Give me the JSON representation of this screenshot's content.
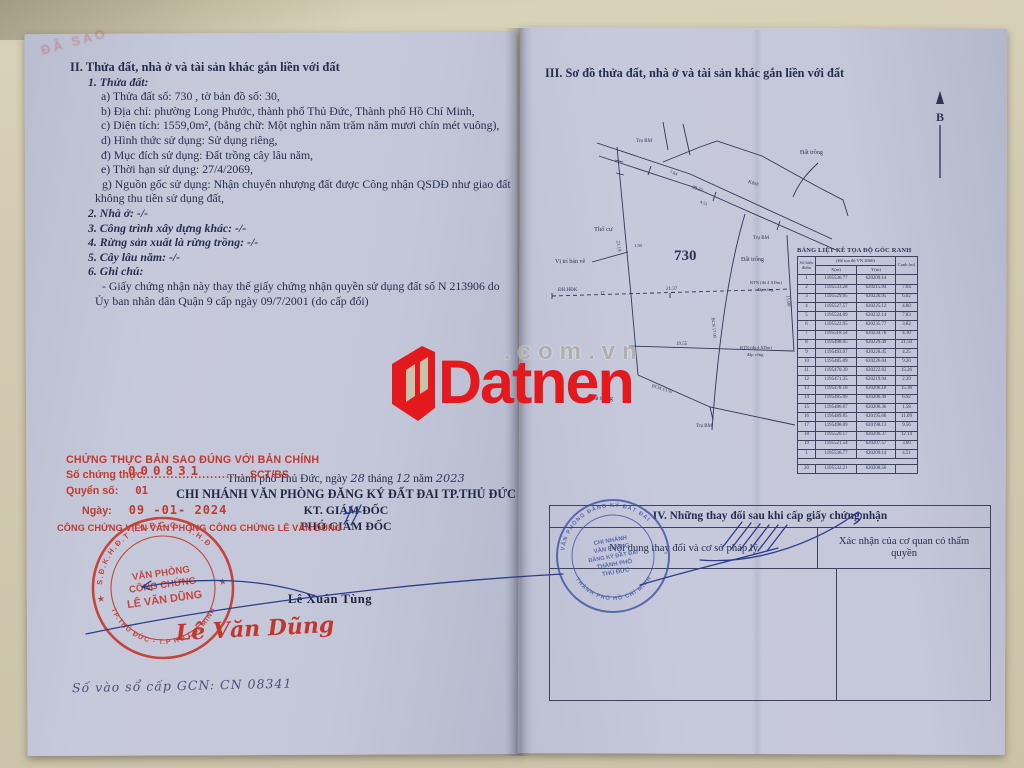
{
  "watermark": {
    "brand": "Datnen",
    "suffix": ".com.vn"
  },
  "colors": {
    "accent_red": "#e3191d",
    "stamp_red": "#c43c31",
    "stamp_blue": "#3f51a3",
    "page": "#c3c6d8",
    "ink": "#262e50"
  },
  "left_page": {
    "faint_corner_stamp": "ĐÃ SAO",
    "section2": {
      "heading": "II. Thửa đất, nhà ở và tài sản khác gắn liền với đất",
      "lines": [
        {
          "style": "h2",
          "text": "1. Thửa đất:"
        },
        {
          "style": "item",
          "text": "a) Thửa đất số: 730      , tờ bản đồ số: 30,"
        },
        {
          "style": "item",
          "text": "b) Địa chỉ: phường Long Phước, thành phố Thủ Đức, Thành phố Hồ Chí Minh,"
        },
        {
          "style": "item",
          "text": "c) Diện tích: 1559,0m², (bằng chữ: Một nghìn năm trăm năm mươi chín mét vuông),"
        },
        {
          "style": "item",
          "text": "d) Hình thức sử dụng: Sử dụng riêng,"
        },
        {
          "style": "item",
          "text": "đ) Mục đích sử dụng: Đất trồng cây lâu năm,"
        },
        {
          "style": "item",
          "text": "e) Thời hạn sử dụng: 27/4/2069,"
        },
        {
          "style": "wrap",
          "text": "g) Nguồn gốc sử dụng: Nhận chuyển nhượng đất được Công nhận QSDĐ như giao đất không thu tiền sử dụng đất,"
        },
        {
          "style": "h2",
          "text": "2. Nhà ở: -/-"
        },
        {
          "style": "h2",
          "text": "3. Công trình xây dựng khác: -/-"
        },
        {
          "style": "h2",
          "text": "4. Rừng sản xuất là rừng trồng: -/-"
        },
        {
          "style": "h2",
          "text": "5. Cây lâu năm: -/-"
        },
        {
          "style": "h2",
          "text": "6. Ghi chú:"
        },
        {
          "style": "wrap",
          "text": "- Giấy chứng nhận này thay thế giấy chứng nhận quyền sử dụng đất số N 213906 do Ủy ban nhân dân Quận 9 cấp ngày 09/7/2001 (do cấp đổi)"
        }
      ]
    },
    "certification": {
      "line1": "CHỨNG THỰC BẢN SAO ĐÚNG VỚI BẢN CHÍNH",
      "serial_label": "Số chứng thực",
      "serial_dots": "...........................",
      "serial_number": "000831",
      "serial_suffix": "SCT/BS",
      "book_label": "Quyển số:",
      "book_number": "01",
      "date_label": "Ngày:",
      "date_stamp": "09 -01- 2024",
      "notary_line": "CÔNG CHỨNG VIÊN VĂN PHÒNG CÔNG CHỨNG LÊ VĂN DŨNG"
    },
    "issuing": {
      "pd1": "Thành phố Thủ Đức, ngày",
      "day": "28",
      "pd2": "tháng",
      "month": "12",
      "pd3": "năm",
      "year": "2023",
      "office": "CHI NHÁNH VĂN PHÒNG ĐĂNG KÝ ĐẤT ĐAI TP.THỦ ĐỨC",
      "title1": "KT. GIÁM ĐỐC",
      "title2": "PHÓ GIÁM ĐỐC",
      "signer": "Lê Xuân Tùng"
    },
    "red_stamp": {
      "ring_top": "S.Đ.K.H.Đ.T · V.P.C.C · T.H.Đ",
      "ring_bottom": "TP.THỦ ĐỨC - T.P HỒ CHÍ MINH",
      "center1": "VĂN PHÒNG",
      "center2": "CÔNG CHỨNG",
      "center3": "LÊ VĂN DŨNG",
      "star": "★"
    },
    "blue_stamp": {
      "ring_top": "VĂN PHÒNG ĐĂNG KÝ ĐẤT ĐAI",
      "ring_bottom": "THÀNH PHỐ HỒ CHÍ MINH",
      "center": [
        "CHI NHÁNH",
        "VĂN PHÒNG",
        "ĐĂNG KÝ ĐẤT ĐAI",
        "THÀNH PHỐ",
        "THỦ ĐỨC"
      ]
    },
    "notary_signature": "Lê Văn Dũng",
    "registry_line": "Số vào sổ cấp GCN: CN  08341"
  },
  "right_page": {
    "heading": "III. Sơ đồ thửa đất, nhà ở và tài sản khác gắn liền với đất",
    "north_label": "B",
    "diagram": {
      "labels": [
        {
          "t": "Trụ BM",
          "x": 636,
          "y": 139,
          "s": 5
        },
        {
          "t": "Trụ BM",
          "x": 753,
          "y": 236,
          "s": 5
        },
        {
          "t": "Trụ BM",
          "x": 696,
          "y": 424,
          "s": 5
        },
        {
          "t": "Thổ cư",
          "x": 594,
          "y": 226,
          "s": 6.5
        },
        {
          "t": "Vị trí bản vẽ",
          "x": 555,
          "y": 259,
          "s": 6
        },
        {
          "t": "730",
          "x": 674,
          "y": 248,
          "s": 15,
          "b": 1
        },
        {
          "t": "Đất trống",
          "x": 741,
          "y": 257,
          "s": 6
        },
        {
          "t": "Đất trồng",
          "x": 800,
          "y": 150,
          "s": 6
        },
        {
          "t": "Kênh",
          "x": 748,
          "y": 180,
          "s": 5,
          "r": 16
        },
        {
          "t": "ĐH.HĐK",
          "x": 558,
          "y": 288,
          "s": 5
        },
        {
          "t": "17",
          "x": 600,
          "y": 290,
          "s": 4.5
        },
        {
          "t": "21.37",
          "x": 666,
          "y": 287,
          "s": 5
        },
        {
          "t": "19.55",
          "x": 676,
          "y": 342,
          "s": 5
        },
        {
          "t": "BTN (đá 4 XDm)",
          "x": 750,
          "y": 280,
          "s": 4.5
        },
        {
          "t": "đắp cống",
          "x": 757,
          "y": 287,
          "s": 4.5
        },
        {
          "t": "BTN (đá 4 XDm)",
          "x": 740,
          "y": 345,
          "s": 4.5
        },
        {
          "t": "đắp cống",
          "x": 747,
          "y": 352,
          "s": 4.5
        },
        {
          "t": "20.37",
          "x": 692,
          "y": 185,
          "s": 5,
          "r": 22
        },
        {
          "t": "7.64",
          "x": 670,
          "y": 169,
          "s": 4.5,
          "r": 20
        },
        {
          "t": "4.51",
          "x": 700,
          "y": 199,
          "s": 4.5,
          "r": 22
        },
        {
          "t": "23.19",
          "x": 617,
          "y": 238,
          "s": 5,
          "r": 82
        },
        {
          "t": "1.50",
          "x": 634,
          "y": 243,
          "s": 4.5
        },
        {
          "t": "BCM  13.50",
          "x": 652,
          "y": 383,
          "s": 4.5,
          "r": 17
        },
        {
          "t": "BCN  17.00",
          "x": 713,
          "y": 315,
          "s": 4.5,
          "r": 84
        },
        {
          "t": "11.00",
          "x": 787,
          "y": 293,
          "s": 5,
          "r": 84
        },
        {
          "t": "Đất trống",
          "x": 590,
          "y": 396,
          "s": 6
        }
      ]
    },
    "coord_table": {
      "title": "BẢNG LIỆT KÊ TỌA ĐỘ GÓC RANH",
      "col_point": "Số hiệu điểm",
      "col_system": "(Hệ tọa độ VN 2000)",
      "col_x": "X(m)",
      "col_y": "Y(m)",
      "col_edge": "Cạnh (m)",
      "rows": [
        {
          "point": "1",
          "x": "1195536.77",
          "y": "620209.14",
          "edge": ""
        },
        {
          "point": "2",
          "x": "1195533.28",
          "y": "620215.94",
          "edge": "7.64"
        },
        {
          "point": "3",
          "x": "1195529.95",
          "y": "620220.95",
          "edge": "6.02"
        },
        {
          "point": "4",
          "x": "1195527.57",
          "y": "620225.12",
          "edge": "4.80"
        },
        {
          "point": "5",
          "x": "1195524.09",
          "y": "620232.14",
          "edge": "7.83"
        },
        {
          "point": "6",
          "x": "1195522.95",
          "y": "620235.77",
          "edge": "3.82"
        },
        {
          "point": "7",
          "x": "1195518.54",
          "y": "620234.76",
          "edge": "4.10"
        },
        {
          "point": "8",
          "x": "1195498.05",
          "y": "620229.49",
          "edge": "21.50"
        },
        {
          "point": "9",
          "x": "1195493.97",
          "y": "620228.45",
          "edge": "4.25"
        },
        {
          "point": "10",
          "x": "1195485.09",
          "y": "620226.04",
          "edge": "9.20"
        },
        {
          "point": "11",
          "x": "1195470.39",
          "y": "620222.83",
          "edge": "15.26"
        },
        {
          "point": "12",
          "x": "1195471.35",
          "y": "620219.94",
          "edge": "2.39"
        },
        {
          "point": "13",
          "x": "1195478.18",
          "y": "620206.18",
          "edge": "15.36"
        },
        {
          "point": "14",
          "x": "1195485.09",
          "y": "620206.49",
          "edge": "6.92"
        },
        {
          "point": "15",
          "x": "1195486.67",
          "y": "620206.36",
          "edge": "1.58"
        },
        {
          "point": "16",
          "x": "1195489.85",
          "y": "620195.66",
          "edge": "11.09"
        },
        {
          "point": "17",
          "x": "1195498.09",
          "y": "620198.13",
          "edge": "9.56"
        },
        {
          "point": "18",
          "x": "1195520.17",
          "y": "620206.37",
          "edge": "12.14"
        },
        {
          "point": "19",
          "x": "1195521.54",
          "y": "620207.57",
          "edge": "3.00"
        },
        {
          "point": "1",
          "x": "1195536.77",
          "y": "620209.14",
          "edge": "4.51"
        },
        {
          "gap": true
        },
        {
          "point": "20",
          "x": "1195532.21",
          "y": "620208.56",
          "edge": ""
        }
      ]
    },
    "section4": {
      "title": "IV. Những thay đổi sau khi cấp giấy chứng nhận",
      "col1": "Nội dung thay đổi và cơ sở pháp lý",
      "col2": "Xác nhận của cơ quan có thẩm quyền"
    }
  }
}
